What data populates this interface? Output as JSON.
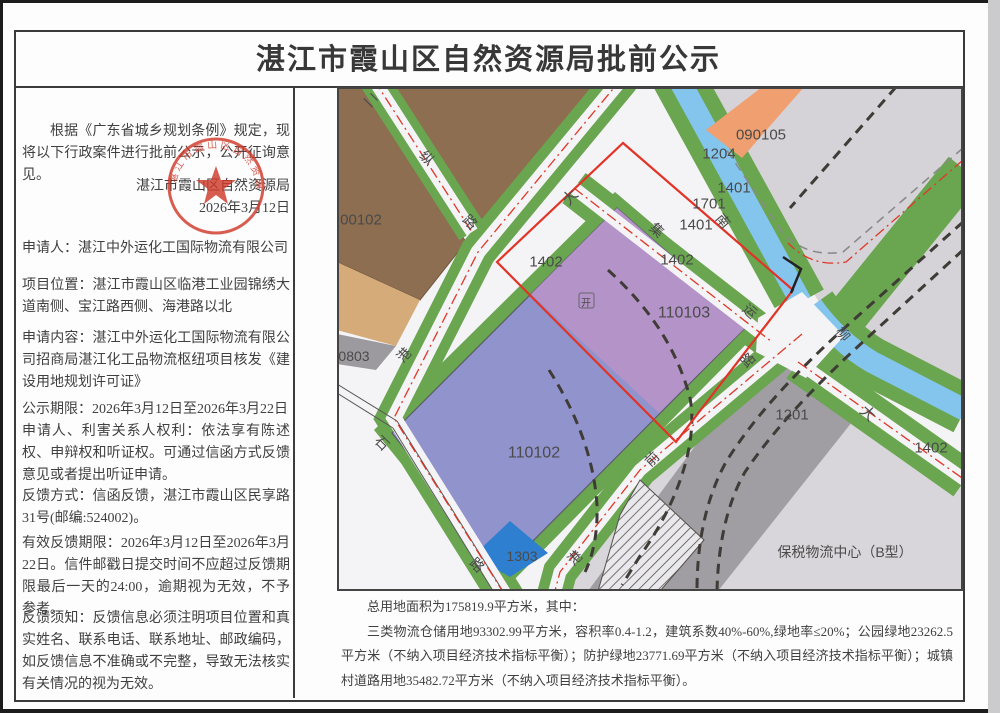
{
  "header": {
    "title": "湛江市霞山区自然资源局批前公示"
  },
  "left": {
    "intro": "根据《广东省城乡规划条例》规定，现将以下行政案件进行批前公示，公开征询意见。",
    "agency": "湛江市霞山区自然资源局",
    "date": "2026年3月12日",
    "applicant": "申请人：湛江中外运化工国际物流有限公司",
    "location": "项目位置：湛江市霞山区临港工业园锦绣大道南侧、宝江路西侧、海港路以北",
    "content": "申请内容：湛江中外运化工国际物流有限公司招商局湛江化工品物流枢纽项目核发《建设用地规划许可证》",
    "period": "公示期限：2026年3月12日至2026年3月22日",
    "rights": "申请人、利害关系人权利：依法享有陈述权、申辩权和听证权。可通过信函方式反馈意见或者提出听证申请。",
    "feedback": "反馈方式：信函反馈，湛江市霞山区民享路31号(邮编:524002)。",
    "deadline": "有效反馈期限：2026年3月12日至2026年3月22日。信件邮戳日提交时间不应超过反馈期限最后一天的24:00，逾期视为无效，不予参考。",
    "notice": "反馈须知：反馈信息必须注明项目位置和真实姓名、联系电话、联系地址、邮政编码，如反馈信息不准确或不完整，导致无法核实有关情况的视为无效。"
  },
  "seal": {
    "text": "湛江市霞山区自然资源局",
    "color": "#cf3a2c"
  },
  "summary": {
    "line1": "总用地面积为175819.9平方米，其中：",
    "line2": "三类物流仓储用地93302.99平方米，容积率0.4-1.2，建筑系数40%-60%,绿地率≤20%；公园绿地23262.5平方米（不纳入项目经济技术指标平衡）；防护绿地23771.69平方米（不纳入项目经济技术指标平衡）；城镇村道路用地35482.72平方米（不纳入项目经济技术指标平衡）。"
  },
  "map": {
    "colors": {
      "green": "#6aa550",
      "canal_blue": "#84c5ee",
      "parcel_pink_purple": "#b493c9",
      "parcel_blue_purple": "#9193cd",
      "parcel_blue": "#2f7fd0",
      "parcel_orange": "#ef9f70",
      "parcel_brown": "#8d6e50",
      "parcel_tan": "#d5ab79",
      "parcel_gray": "#a09da3",
      "light_gray": "#d5d3d7",
      "red_line": "#e23327",
      "road_white": "#f4f3f6"
    },
    "labels": [
      {
        "t": "00102",
        "x": 361,
        "y": 219,
        "s": 15
      },
      {
        "t": "0803",
        "x": 354,
        "y": 356,
        "s": 14
      },
      {
        "t": "090105",
        "x": 761,
        "y": 134,
        "s": 15
      },
      {
        "t": "1204",
        "x": 719,
        "y": 153,
        "s": 15
      },
      {
        "t": "1401",
        "x": 734,
        "y": 187,
        "s": 15
      },
      {
        "t": "1701",
        "x": 709,
        "y": 203,
        "s": 15
      },
      {
        "t": "1401",
        "x": 696,
        "y": 224,
        "s": 15
      },
      {
        "t": "1402",
        "x": 677,
        "y": 259,
        "s": 15
      },
      {
        "t": "1402",
        "x": 546,
        "y": 261,
        "s": 15
      },
      {
        "t": "110103",
        "x": 684,
        "y": 312,
        "s": 16
      },
      {
        "t": "110102",
        "x": 534,
        "y": 452,
        "s": 16
      },
      {
        "t": "1303",
        "x": 522,
        "y": 556,
        "s": 14
      },
      {
        "t": "1201",
        "x": 792,
        "y": 414,
        "s": 15
      },
      {
        "t": "1402",
        "x": 931,
        "y": 447,
        "s": 15
      },
      {
        "t": "保税物流中心（B型）",
        "x": 845,
        "y": 552,
        "s": 14
      },
      {
        "t": "开",
        "x": 586,
        "y": 303,
        "s": 10
      },
      {
        "t": "二",
        "x": 371,
        "y": 100,
        "r": 45,
        "s": 14
      },
      {
        "t": "纵",
        "x": 427,
        "y": 158,
        "r": 45,
        "s": 14
      },
      {
        "t": "路",
        "x": 470,
        "y": 222,
        "r": 45,
        "s": 14
      },
      {
        "t": "大",
        "x": 570,
        "y": 197,
        "r": -48,
        "s": 15
      },
      {
        "t": "港",
        "x": 404,
        "y": 355,
        "r": -48,
        "s": 14
      },
      {
        "t": "石",
        "x": 382,
        "y": 443,
        "r": 45,
        "s": 14
      },
      {
        "t": "路",
        "x": 477,
        "y": 565,
        "r": 45,
        "s": 14
      },
      {
        "t": "集",
        "x": 657,
        "y": 230,
        "r": 42,
        "s": 14
      },
      {
        "t": "运",
        "x": 750,
        "y": 311,
        "r": 42,
        "s": 14
      },
      {
        "t": "路",
        "x": 748,
        "y": 360,
        "r": -45,
        "s": 14
      },
      {
        "t": "前",
        "x": 652,
        "y": 459,
        "r": -45,
        "s": 14
      },
      {
        "t": "港",
        "x": 575,
        "y": 558,
        "r": -45,
        "s": 14
      },
      {
        "t": "南",
        "x": 723,
        "y": 221,
        "r": 50,
        "s": 14
      },
      {
        "t": "柳",
        "x": 843,
        "y": 334,
        "r": 50,
        "s": 14
      },
      {
        "t": "大",
        "x": 868,
        "y": 413,
        "r": 42,
        "s": 15
      }
    ]
  }
}
